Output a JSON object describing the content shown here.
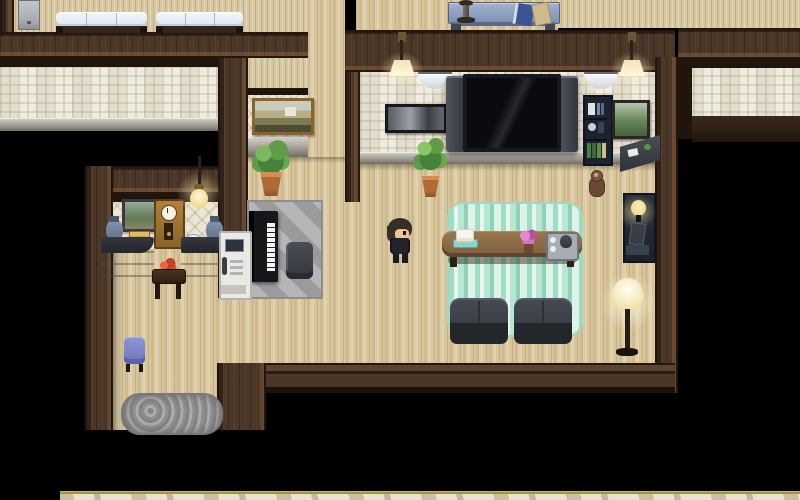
{
  "app": {
    "type": "game",
    "style": "rpg-maker-top-down-interior",
    "canvas_px": {
      "width": 800,
      "height": 500
    },
    "visible_text": []
  },
  "labels": {
    "player": "Player character",
    "tv": "Wall-mounted television",
    "piano": "Upright piano",
    "intercom": "Intercom kiosk",
    "doormat": "Shaggy doormat at the south doorway",
    "clock": "Grandfather clock",
    "bookshelf": "Bookshelf",
    "floor_lamp": "Floor lamp"
  },
  "palette": {
    "darkness": "#000000",
    "wall_brown": "#4b3728",
    "wall_frame_dark": "#20150d",
    "floor_wood": "#d8c59a",
    "plank_wall": "#d7c8a0",
    "wallpaper_tile": "#f0ebdf",
    "baseboard_gray": "#a39e93",
    "rug_teal": "#b7e7d3",
    "rug_gray": "#a9a9ab",
    "sofa_dark": "#3b3f47",
    "table_brown": "#8f6d47",
    "bed_blue": "#e9eef6",
    "console_blue": "#8e9fbe",
    "lamp_glow": "#fff3c4",
    "marble_floor": "#e9e2d0",
    "gold_trim": "#a3943c"
  },
  "player": {
    "x": 385,
    "y": 218,
    "facing": "right",
    "hair_color": "#372e26",
    "outfit_color": "#23232b"
  },
  "rooms": [
    {
      "id": "north-bedroom",
      "label": "North bedroom: two beds, dresser, blue console table with lamp and books"
    },
    {
      "id": "dark-room-west",
      "label": "Unlit room at upper left (tile wallpaper band visible, interior dark)"
    },
    {
      "id": "office",
      "label": "Office / reception: twin curved desks, vases, grandfather clock, intercom kiosk"
    },
    {
      "id": "piano-nook",
      "label": "Piano nook: upright piano, chair, gray diamond rug, gold painting, plant"
    },
    {
      "id": "living-room",
      "label": "Living room: wall TV with speakers, sconces, wall lamps, teal rug, sofas, coffee table"
    },
    {
      "id": "dark-room-east",
      "label": "Unlit room on the right side"
    },
    {
      "id": "south-exit",
      "label": "South doorway: blue stool, shaggy doormat, marble hall strip below"
    }
  ],
  "entities": [
    {
      "name": "dresser-cabinet",
      "room": "north-bedroom",
      "rect": [
        18,
        0,
        20,
        28
      ]
    },
    {
      "name": "bed-left",
      "room": "north-bedroom",
      "rect": [
        56,
        12,
        91,
        21
      ]
    },
    {
      "name": "bed-right",
      "room": "north-bedroom",
      "rect": [
        156,
        12,
        87,
        21
      ]
    },
    {
      "name": "console-table-blue",
      "room": "north-bedroom",
      "rect": [
        448,
        2,
        110,
        28
      ],
      "items": [
        "dark-table-lamp",
        "blue-book",
        "tan-book"
      ]
    },
    {
      "name": "landscape-painting-gold",
      "room": "piano-nook",
      "rect": [
        252,
        98,
        56,
        31
      ]
    },
    {
      "name": "potted-plant",
      "room": "piano-nook",
      "rect": [
        250,
        140,
        42,
        58
      ]
    },
    {
      "name": "gray-diamond-rug",
      "room": "piano-nook",
      "rect": [
        247,
        200,
        72,
        95
      ]
    },
    {
      "name": "upright-piano",
      "room": "piano-nook",
      "rect": [
        249,
        211,
        29,
        71
      ]
    },
    {
      "name": "piano-chair",
      "room": "piano-nook",
      "rect": [
        286,
        242,
        27,
        37
      ]
    },
    {
      "name": "window-painting",
      "room": "office",
      "rect": [
        122,
        199,
        29,
        27
      ]
    },
    {
      "name": "grandfather-clock",
      "room": "office",
      "rect": [
        154,
        199,
        27,
        46
      ]
    },
    {
      "name": "hanging-lamp",
      "room": "office",
      "rect": [
        190,
        158,
        32,
        52
      ]
    },
    {
      "name": "vase-left",
      "room": "office",
      "rect": [
        106,
        216,
        17,
        28
      ]
    },
    {
      "name": "vase-right",
      "room": "office",
      "rect": [
        206,
        216,
        17,
        28
      ]
    },
    {
      "name": "golden-box",
      "room": "office",
      "rect": [
        129,
        231,
        19,
        14
      ]
    },
    {
      "name": "white-bowl",
      "room": "office",
      "rect": [
        185,
        234,
        15,
        10
      ]
    },
    {
      "name": "reception-desk-left",
      "room": "office",
      "rect": [
        101,
        237,
        53,
        50
      ]
    },
    {
      "name": "reception-desk-right",
      "room": "office",
      "rect": [
        181,
        237,
        52,
        50
      ]
    },
    {
      "name": "flower-side-table",
      "room": "office",
      "rect": [
        152,
        258,
        32,
        44
      ]
    },
    {
      "name": "intercom-kiosk",
      "room": "office",
      "rect": [
        219,
        231,
        29,
        65
      ]
    },
    {
      "name": "wall-lamp-left",
      "room": "living-room",
      "rect": [
        381,
        32,
        42,
        56
      ]
    },
    {
      "name": "wall-lamp-right",
      "room": "living-room",
      "rect": [
        611,
        32,
        42,
        56
      ]
    },
    {
      "name": "sconce-light-left",
      "room": "living-room",
      "rect": [
        418,
        72,
        34,
        17
      ]
    },
    {
      "name": "sconce-light-right",
      "room": "living-room",
      "rect": [
        584,
        72,
        34,
        17
      ]
    },
    {
      "name": "panoramic-picture",
      "room": "living-room",
      "rect": [
        385,
        104,
        56,
        23
      ]
    },
    {
      "name": "wall-tv",
      "room": "living-room",
      "rect": [
        446,
        74,
        132,
        80
      ]
    },
    {
      "name": "bookshelf",
      "room": "living-room",
      "rect": [
        583,
        95,
        26,
        67
      ]
    },
    {
      "name": "green-painting",
      "room": "living-room",
      "rect": [
        612,
        100,
        32,
        33
      ]
    },
    {
      "name": "corner-desk",
      "room": "living-room",
      "rect": [
        620,
        135,
        40,
        37
      ]
    },
    {
      "name": "potted-plant-2",
      "room": "living-room",
      "rect": [
        414,
        136,
        33,
        62
      ]
    },
    {
      "name": "teal-rug",
      "room": "living-room",
      "rect": [
        447,
        202,
        132,
        131
      ]
    },
    {
      "name": "coffee-table",
      "room": "living-room",
      "rect": [
        442,
        231,
        140,
        36
      ]
    },
    {
      "name": "cake-plate",
      "room": "living-room",
      "rect": [
        453,
        229,
        23,
        17
      ]
    },
    {
      "name": "pink-flowers",
      "room": "living-room",
      "rect": [
        517,
        228,
        23,
        26
      ]
    },
    {
      "name": "tea-tray",
      "room": "living-room",
      "rect": [
        546,
        232,
        29,
        25
      ]
    },
    {
      "name": "sofa-left",
      "room": "living-room",
      "rect": [
        450,
        298,
        58,
        46
      ]
    },
    {
      "name": "sofa-right",
      "room": "living-room",
      "rect": [
        514,
        298,
        58,
        46
      ]
    },
    {
      "name": "plush-toy",
      "room": "living-room",
      "rect": [
        587,
        170,
        18,
        26
      ]
    },
    {
      "name": "lamp-side-table",
      "room": "living-room",
      "rect": [
        623,
        193,
        29,
        66
      ]
    },
    {
      "name": "floor-lamp",
      "room": "living-room",
      "rect": [
        600,
        272,
        56,
        86
      ]
    },
    {
      "name": "blue-stool",
      "room": "south-exit",
      "rect": [
        124,
        337,
        21,
        35
      ]
    },
    {
      "name": "doormat-rug",
      "room": "south-exit",
      "rect": [
        121,
        393,
        98,
        38
      ]
    },
    {
      "name": "gold-trim-strip",
      "room": "south-exit",
      "rect": [
        60,
        491,
        740,
        3
      ]
    },
    {
      "name": "marble-hall-floor",
      "room": "south-exit",
      "rect": [
        60,
        494,
        740,
        6
      ]
    }
  ]
}
